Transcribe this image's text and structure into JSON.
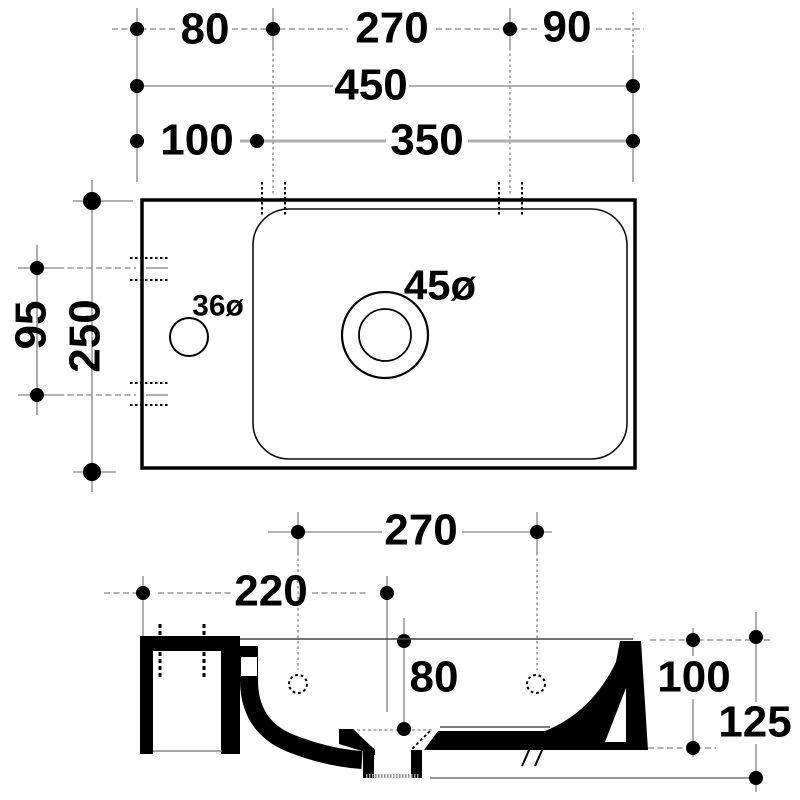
{
  "plan": {
    "d80": "80",
    "d270": "270",
    "d90": "90",
    "d450": "450",
    "d100": "100",
    "d350": "350",
    "d95": "95",
    "d250": "250",
    "tap": "36ø",
    "drain": "45ø"
  },
  "section": {
    "d270": "270",
    "d220": "220",
    "d80": "80",
    "d100": "100",
    "d125": "125"
  },
  "colors": {
    "line": "#000000",
    "dim_line": "#9a9a9a",
    "background": "#ffffff"
  }
}
